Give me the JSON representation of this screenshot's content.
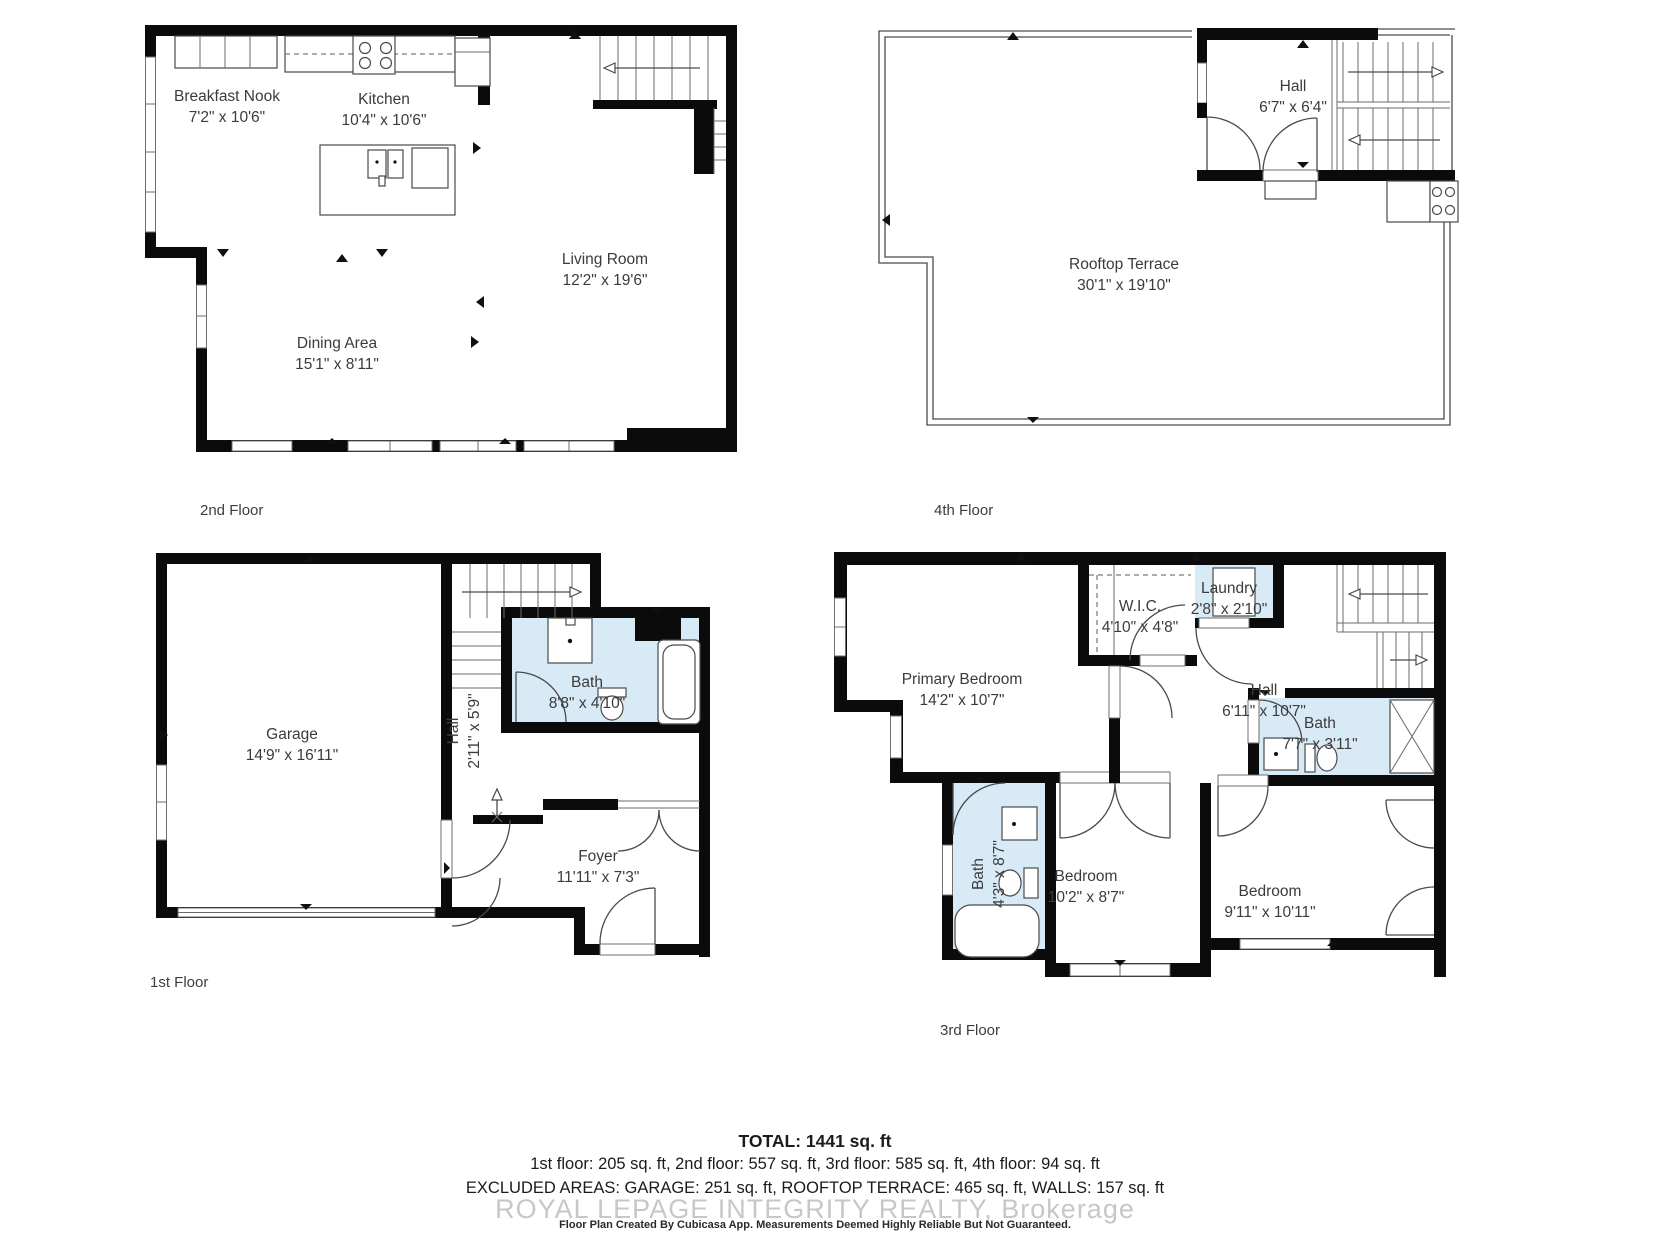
{
  "colors": {
    "wall": "#0b0b0b",
    "bath_fill": "#d9eaf7",
    "line": "#4a4a4a",
    "label_text": "#3b3b3b",
    "watermark_text": "#c7c7c7"
  },
  "floors": [
    {
      "caption": "2nd Floor",
      "rooms": [
        {
          "name": "Breakfast Nook",
          "dims": "7'2\" x 10'6\""
        },
        {
          "name": "Kitchen",
          "dims": "10'4\" x 10'6\""
        },
        {
          "name": "Living Room",
          "dims": "12'2\" x 19'6\""
        },
        {
          "name": "Dining Area",
          "dims": "15'1\" x 8'11\""
        }
      ]
    },
    {
      "caption": "4th Floor",
      "rooms": [
        {
          "name": "Hall",
          "dims": "6'7\" x 6'4\""
        },
        {
          "name": "Rooftop Terrace",
          "dims": "30'1\" x 19'10\""
        }
      ]
    },
    {
      "caption": "1st Floor",
      "rooms": [
        {
          "name": "Garage",
          "dims": "14'9\" x 16'11\""
        },
        {
          "name": "Hall",
          "dims": "2'11\" x 5'9\""
        },
        {
          "name": "Bath",
          "dims": "8'8\" x 4'10\""
        },
        {
          "name": "Foyer",
          "dims": "11'11\" x 7'3\""
        }
      ]
    },
    {
      "caption": "3rd Floor",
      "rooms": [
        {
          "name": "Primary Bedroom",
          "dims": "14'2\" x 10'7\""
        },
        {
          "name": "W.I.C.",
          "dims": "4'10\" x 4'8\""
        },
        {
          "name": "Laundry",
          "dims": "2'8\" x 2'10\""
        },
        {
          "name": "Hall",
          "dims": "6'11\" x 10'7\""
        },
        {
          "name": "Bath",
          "dims": "7'7\" x 3'11\""
        },
        {
          "name": "Bath",
          "dims": "4'3\" x 8'7\""
        },
        {
          "name": "Bedroom",
          "dims": "10'2\" x 8'7\""
        },
        {
          "name": "Bedroom",
          "dims": "9'11\" x 10'11\""
        }
      ]
    }
  ],
  "summary": {
    "total": "TOTAL: 1441 sq. ft",
    "floors_line": "1st floor: 205 sq. ft, 2nd floor: 557 sq. ft, 3rd floor: 585 sq. ft, 4th floor: 94 sq. ft",
    "excluded_line": "EXCLUDED AREAS: GARAGE: 251 sq. ft, ROOFTOP TERRACE: 465 sq. ft, WALLS: 157 sq. ft",
    "watermark": "ROYAL LEPAGE INTEGRITY REALTY, Brokerage",
    "disclaimer": "Floor Plan Created By Cubicasa App. Measurements Deemed Highly Reliable But Not Guaranteed."
  }
}
